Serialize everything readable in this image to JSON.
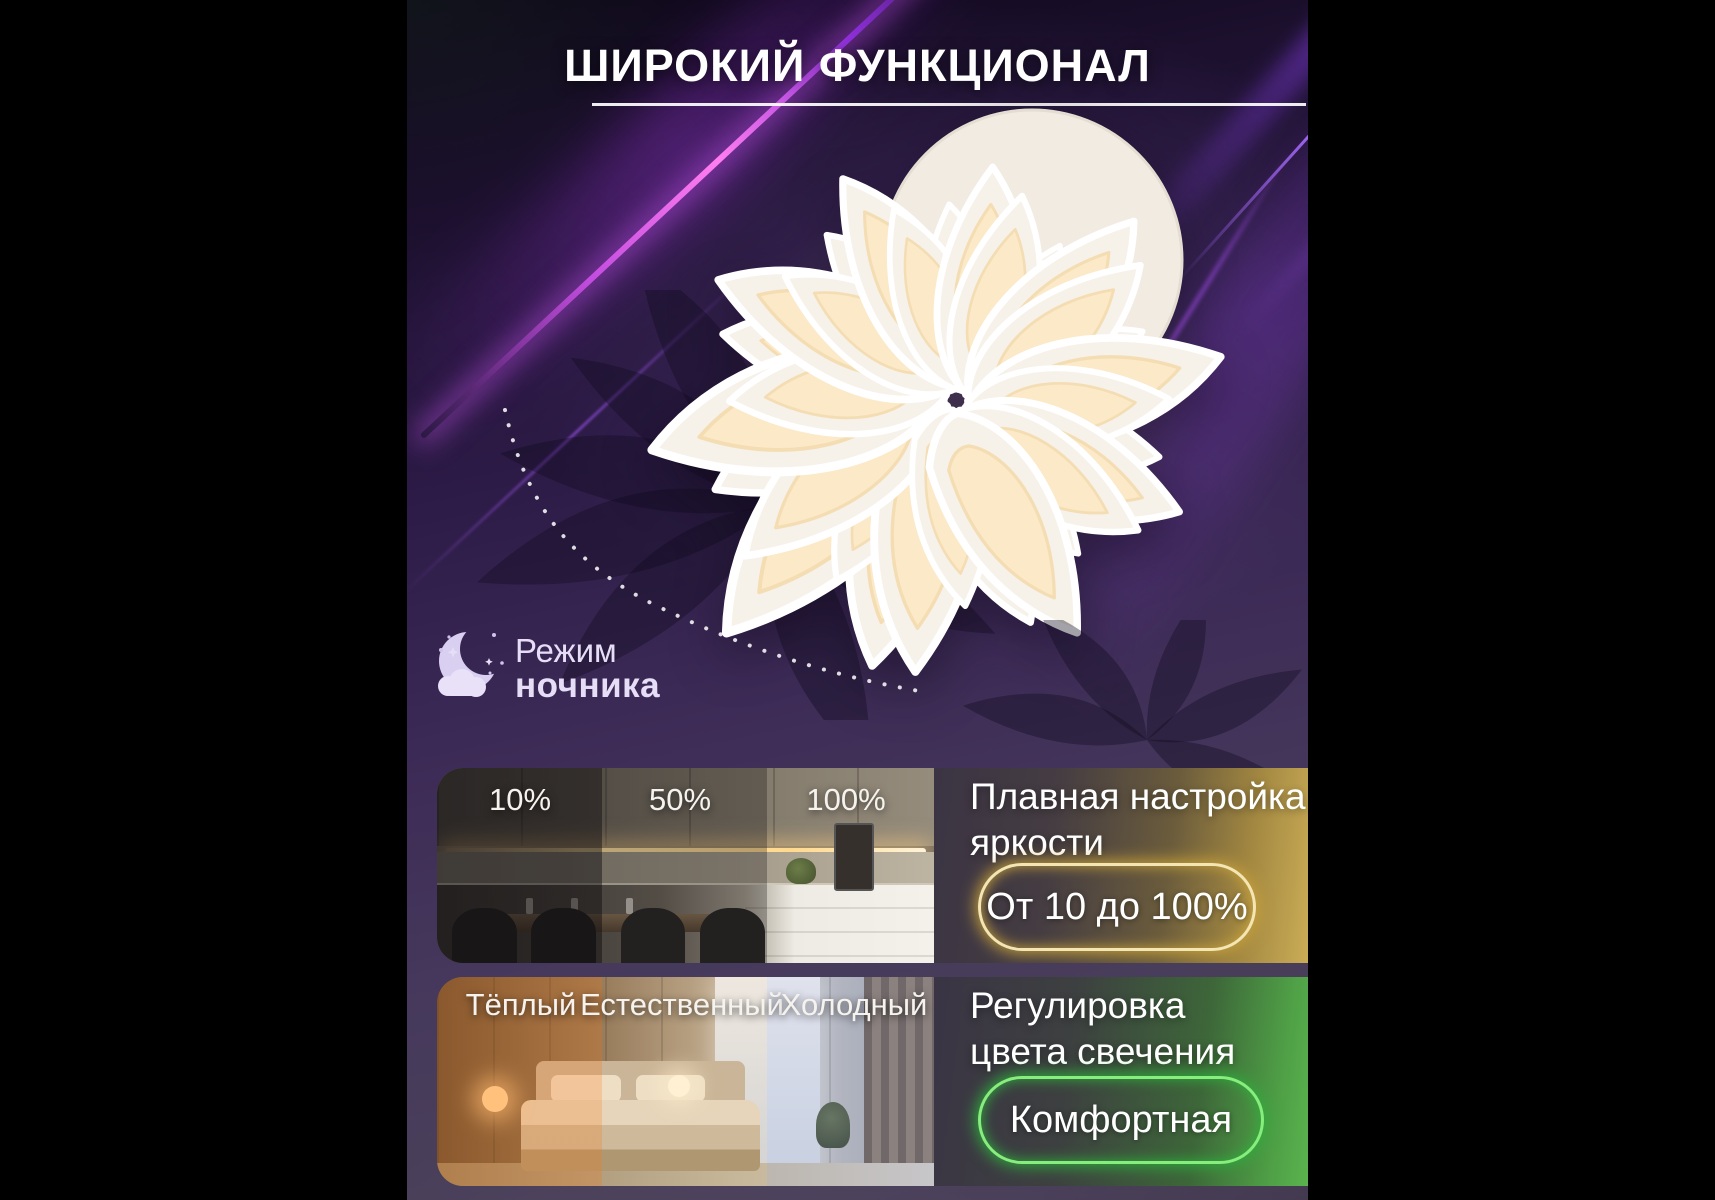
{
  "header": {
    "title": "ШИРОКИЙ ФУНКЦИОНАЛ"
  },
  "night_mode": {
    "icon": "moon-cloud-icon",
    "label_line1": "Режим",
    "label_line2": "ночника"
  },
  "features": [
    {
      "name": "brightness-adjustment",
      "photo_labels": [
        "10%",
        "50%",
        "100%"
      ],
      "heading_line1": "Плавная настройка",
      "heading_line2": "яркости",
      "badge_label": "От 10 до 100%",
      "accent_color": "#f3e6b4",
      "glow_color": "#c9a33b"
    },
    {
      "name": "color-temperature-adjustment",
      "photo_labels": [
        "Тёплый",
        "Естественный",
        "Холодный"
      ],
      "heading_line1": "Регулировка",
      "heading_line2": "цвета свечения",
      "badge_label": "Комфортная",
      "accent_color": "#86ee7c",
      "glow_color": "#2fae3c"
    }
  ],
  "background": {
    "base_color": "#3c2b57",
    "beam_color": "#c44de0",
    "title_underline_color": "#ffffff"
  }
}
